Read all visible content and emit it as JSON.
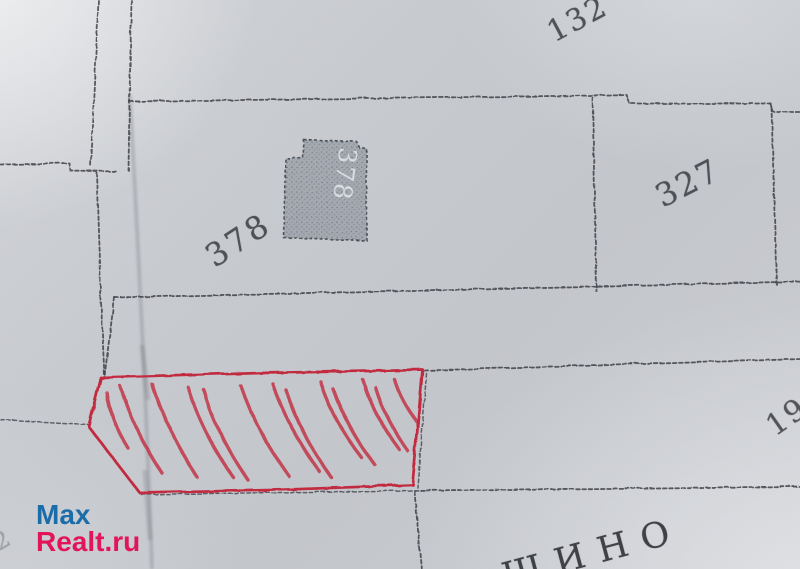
{
  "document": {
    "kind": "scanned cadastral plot plan photo",
    "place_name_partial": "ЩИНО"
  },
  "labels": {
    "parcel_132": "132",
    "parcel_378": "378",
    "building_378": "378",
    "parcel_327": "327",
    "parcel_19_partial": "19",
    "faint_mark": "2"
  },
  "watermark": {
    "line1": "Max",
    "line2": "Realt.ru"
  },
  "colors": {
    "paper": "#c7cacf",
    "line": "#44464c",
    "red": "#c22b40",
    "building_fill": "#a3a8af",
    "watermark_blue": "#1b6da9",
    "watermark_red": "#e21559"
  }
}
